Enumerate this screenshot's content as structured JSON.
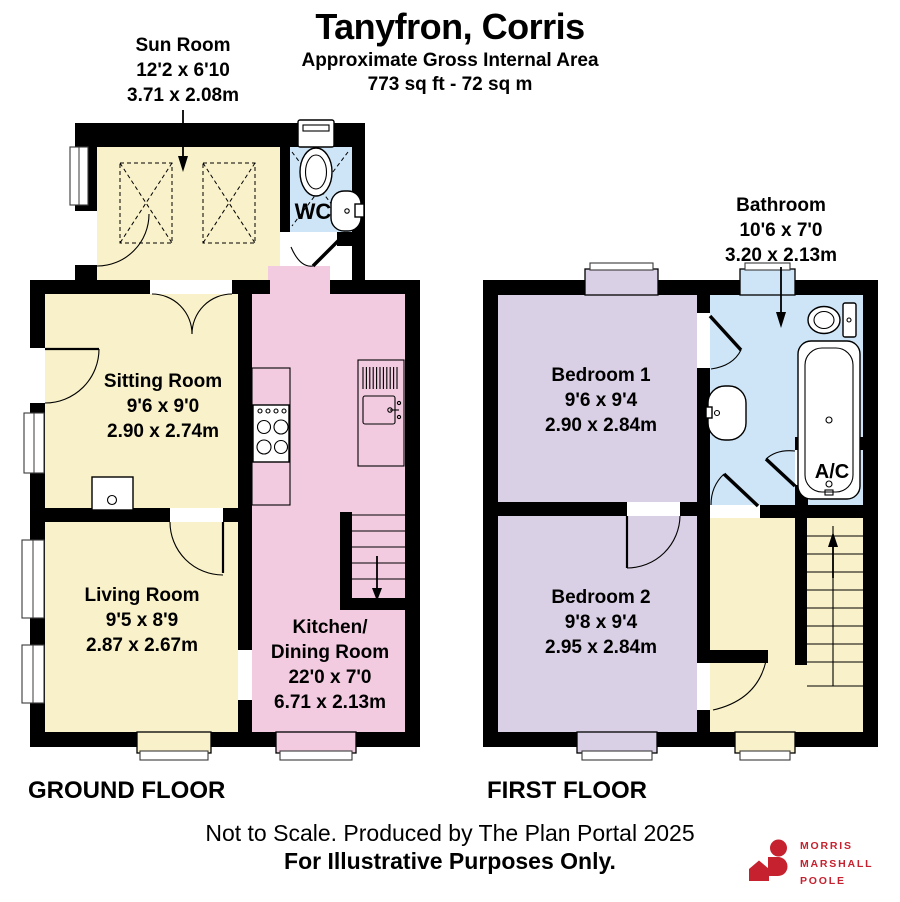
{
  "header": {
    "title": "Tanyfron, Corris",
    "subtitle": "Approximate Gross Internal Area",
    "area": "773 sq ft - 72 sq m"
  },
  "ground_floor": {
    "label": "GROUND FLOOR",
    "rooms": {
      "sun_room": {
        "name": "Sun Room",
        "imperial": "12'2 x 6'10",
        "metric": "3.71 x 2.08m"
      },
      "wc": {
        "name": "WC"
      },
      "sitting_room": {
        "name": "Sitting Room",
        "imperial": "9'6 x 9'0",
        "metric": "2.90 x 2.74m"
      },
      "living_room": {
        "name": "Living Room",
        "imperial": "9'5 x 8'9",
        "metric": "2.87 x 2.67m"
      },
      "kitchen_dining": {
        "name_line1": "Kitchen/",
        "name_line2": "Dining Room",
        "imperial": "22'0 x 7'0",
        "metric": "6.71 x 2.13m"
      }
    }
  },
  "first_floor": {
    "label": "FIRST FLOOR",
    "rooms": {
      "bathroom": {
        "name": "Bathroom",
        "imperial": "10'6 x 7'0",
        "metric": "3.20 x 2.13m"
      },
      "bedroom_1": {
        "name": "Bedroom 1",
        "imperial": "9'6 x 9'4",
        "metric": "2.90 x 2.84m"
      },
      "bedroom_2": {
        "name": "Bedroom 2",
        "imperial": "9'8 x 9'4",
        "metric": "2.95 x 2.84m"
      },
      "airing_cupboard": {
        "name": "A/C"
      }
    }
  },
  "footer": {
    "line1": "Not to Scale. Produced by The Plan Portal 2025",
    "line2": "For Illustrative Purposes Only."
  },
  "logo": {
    "line1": "MORRIS",
    "line2": "MARSHALL",
    "line3": "POOLE"
  },
  "colors": {
    "room-cream": "#F8F1C9",
    "room-pink": "#F3CBE1",
    "room-blue": "#CEE5F7",
    "room-lavender": "#DAD0E5",
    "wall": "#000000",
    "logo-red": "#C5212E"
  }
}
